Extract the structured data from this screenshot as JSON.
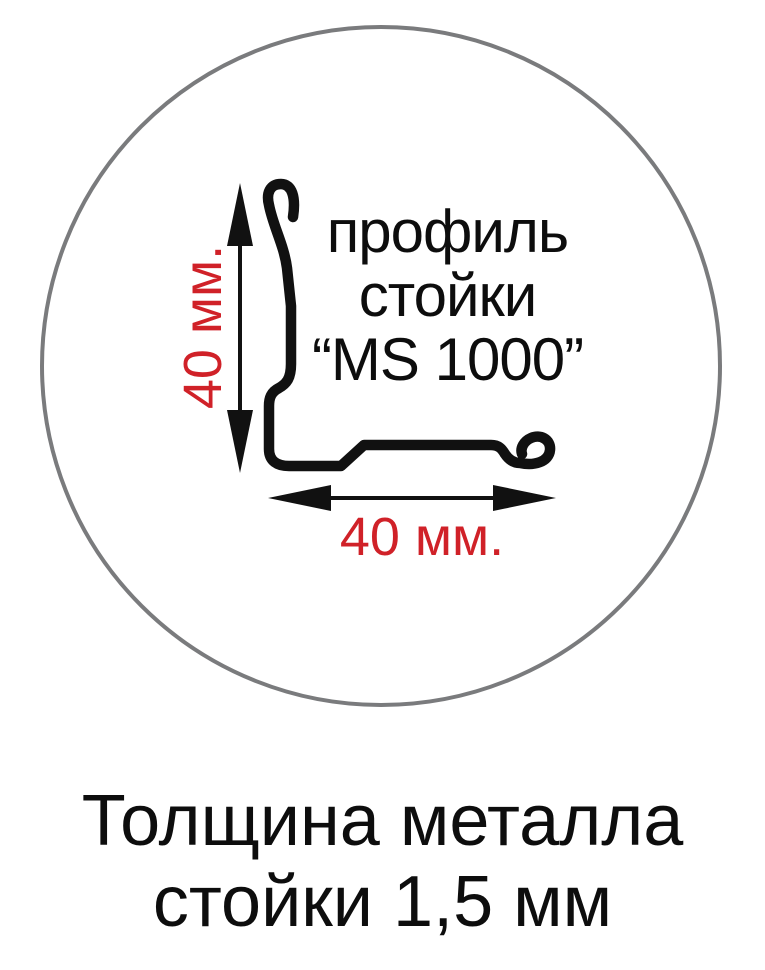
{
  "colors": {
    "background": "#ffffff",
    "ink": "#111111",
    "circle_stroke": "#7a7b7d",
    "dimension_text": "#d02128",
    "caption_text": "#0d0d0d"
  },
  "profile": {
    "label_line1": "профиль",
    "label_line2": "стойки",
    "label_line3": "“MS 1000”"
  },
  "dimensions": {
    "vertical": "40 мм.",
    "horizontal": "40 мм."
  },
  "caption": {
    "line1": "Толщина металла",
    "line2": "стойки 1,5 мм"
  }
}
